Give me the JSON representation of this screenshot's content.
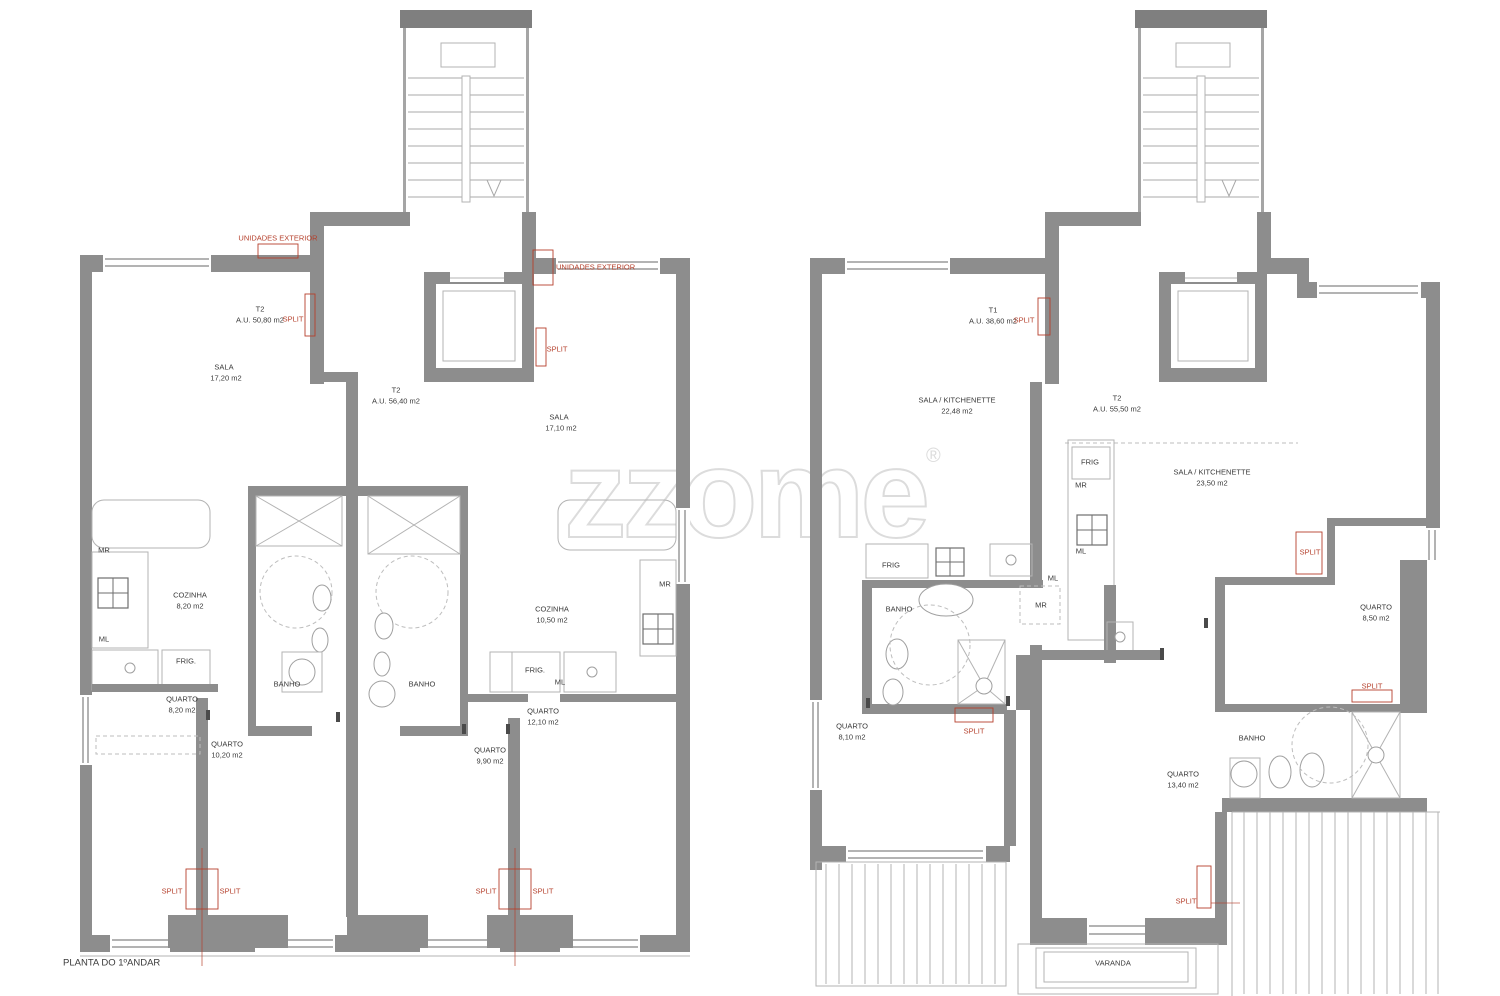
{
  "watermark": {
    "text": "zzome",
    "registered": "®"
  },
  "colors": {
    "wall": "#8d8d8d",
    "red": "#b5402c",
    "text": "#3a3a3a",
    "watermark": "#dcdcdc"
  },
  "drawing_title": "PLANTA DO 1ºANDAR",
  "labels": [
    {
      "name": "unidades-exterior-left",
      "text": "UNIDADES EXTERIOR",
      "x": 278,
      "y": 238,
      "color": "red"
    },
    {
      "name": "unit-t2a-name",
      "text": "T2",
      "x": 260,
      "y": 309
    },
    {
      "name": "unit-t2a-area",
      "text": "A.U. 50,80 m2",
      "x": 260,
      "y": 320
    },
    {
      "name": "split-t2a",
      "text": "SPLIT",
      "x": 293,
      "y": 319,
      "color": "red"
    },
    {
      "name": "sala-a-name",
      "text": "SALA",
      "x": 224,
      "y": 367
    },
    {
      "name": "sala-a-area",
      "text": "17,20 m2",
      "x": 226,
      "y": 378
    },
    {
      "name": "unit-t2b-name",
      "text": "T2",
      "x": 396,
      "y": 390
    },
    {
      "name": "unit-t2b-area",
      "text": "A.U. 56,40 m2",
      "x": 396,
      "y": 401
    },
    {
      "name": "unidades-exterior-right",
      "text": "UNIDADES EXTERIOR",
      "x": 556,
      "y": 267,
      "color": "red",
      "align": "left"
    },
    {
      "name": "split-t2b",
      "text": "SPLIT",
      "x": 557,
      "y": 349,
      "color": "red"
    },
    {
      "name": "sala-b-name",
      "text": "SALA",
      "x": 559,
      "y": 417
    },
    {
      "name": "sala-b-area",
      "text": "17,10 m2",
      "x": 561,
      "y": 428
    },
    {
      "name": "mr-a",
      "text": "MR",
      "x": 104,
      "y": 550
    },
    {
      "name": "cozinha-a-name",
      "text": "COZINHA",
      "x": 190,
      "y": 595
    },
    {
      "name": "cozinha-a-area",
      "text": "8,20 m2",
      "x": 190,
      "y": 606
    },
    {
      "name": "ml-a",
      "text": "ML",
      "x": 104,
      "y": 639
    },
    {
      "name": "frig-a",
      "text": "FRIG.",
      "x": 186,
      "y": 661
    },
    {
      "name": "quarto-1-name",
      "text": "QUARTO",
      "x": 182,
      "y": 699
    },
    {
      "name": "quarto-1-area",
      "text": "8,20 m2",
      "x": 182,
      "y": 710
    },
    {
      "name": "banho-a",
      "text": "BANHO",
      "x": 287,
      "y": 684
    },
    {
      "name": "banho-b",
      "text": "BANHO",
      "x": 422,
      "y": 684
    },
    {
      "name": "quarto-2-name",
      "text": "QUARTO",
      "x": 227,
      "y": 744
    },
    {
      "name": "quarto-2-area",
      "text": "10,20 m2",
      "x": 227,
      "y": 755
    },
    {
      "name": "quarto-3-name",
      "text": "QUARTO",
      "x": 490,
      "y": 750
    },
    {
      "name": "quarto-3-area",
      "text": "9,90 m2",
      "x": 490,
      "y": 761
    },
    {
      "name": "cozinha-b-name",
      "text": "COZINHA",
      "x": 552,
      "y": 609
    },
    {
      "name": "cozinha-b-area",
      "text": "10,50 m2",
      "x": 552,
      "y": 620
    },
    {
      "name": "mr-b",
      "text": "MR",
      "x": 665,
      "y": 584
    },
    {
      "name": "frig-b",
      "text": "FRIG.",
      "x": 535,
      "y": 670
    },
    {
      "name": "ml-b",
      "text": "ML",
      "x": 560,
      "y": 682
    },
    {
      "name": "quarto-4-name",
      "text": "QUARTO",
      "x": 543,
      "y": 711
    },
    {
      "name": "quarto-4-area",
      "text": "12,10 m2",
      "x": 543,
      "y": 722
    },
    {
      "name": "split-bl-1",
      "text": "SPLIT",
      "x": 172,
      "y": 891,
      "color": "red"
    },
    {
      "name": "split-bl-2",
      "text": "SPLIT",
      "x": 230,
      "y": 891,
      "color": "red"
    },
    {
      "name": "split-br-1",
      "text": "SPLIT",
      "x": 486,
      "y": 891,
      "color": "red"
    },
    {
      "name": "split-br-2",
      "text": "SPLIT",
      "x": 543,
      "y": 891,
      "color": "red"
    },
    {
      "name": "drawing-title",
      "text": "PLANTA DO 1ºANDAR",
      "x": 63,
      "y": 963,
      "size": 9.5,
      "align": "left"
    },
    {
      "name": "unit-t1-name",
      "text": "T1",
      "x": 993,
      "y": 310
    },
    {
      "name": "unit-t1-area",
      "text": "A.U. 38,60 m2",
      "x": 993,
      "y": 321
    },
    {
      "name": "split-t1",
      "text": "SPLIT",
      "x": 1024,
      "y": 320,
      "color": "red"
    },
    {
      "name": "sala-kitch-a-name",
      "text": "SALA / KITCHENETTE",
      "x": 957,
      "y": 400
    },
    {
      "name": "sala-kitch-a-area",
      "text": "22,48 m2",
      "x": 957,
      "y": 411
    },
    {
      "name": "unit-t2c-name",
      "text": "T2",
      "x": 1117,
      "y": 398
    },
    {
      "name": "unit-t2c-area",
      "text": "A.U. 55,50 m2",
      "x": 1117,
      "y": 409
    },
    {
      "name": "frig-c",
      "text": "FRIG",
      "x": 1090,
      "y": 462
    },
    {
      "name": "mr-c",
      "text": "MR",
      "x": 1081,
      "y": 485
    },
    {
      "name": "ml-c",
      "text": "ML",
      "x": 1081,
      "y": 551
    },
    {
      "name": "sala-kitch-b-name",
      "text": "SALA / KITCHENETTE",
      "x": 1212,
      "y": 472
    },
    {
      "name": "sala-kitch-b-area",
      "text": "23,50 m2",
      "x": 1212,
      "y": 483
    },
    {
      "name": "split-t2c-1",
      "text": "SPLIT",
      "x": 1310,
      "y": 552,
      "color": "red"
    },
    {
      "name": "quarto-5-name",
      "text": "QUARTO",
      "x": 1376,
      "y": 607
    },
    {
      "name": "quarto-5-area",
      "text": "8,50 m2",
      "x": 1376,
      "y": 618
    },
    {
      "name": "split-t2c-2",
      "text": "SPLIT",
      "x": 1372,
      "y": 686,
      "color": "red"
    },
    {
      "name": "frig-d",
      "text": "FRIG",
      "x": 891,
      "y": 565
    },
    {
      "name": "ml-d",
      "text": "ML",
      "x": 1053,
      "y": 578
    },
    {
      "name": "banho-c",
      "text": "BANHO",
      "x": 899,
      "y": 609
    },
    {
      "name": "mr-d",
      "text": "MR",
      "x": 1041,
      "y": 605
    },
    {
      "name": "quarto-6-name",
      "text": "QUARTO",
      "x": 852,
      "y": 726
    },
    {
      "name": "quarto-6-area",
      "text": "8,10 m2",
      "x": 852,
      "y": 737
    },
    {
      "name": "split-t1-2",
      "text": "SPLIT",
      "x": 974,
      "y": 731,
      "color": "red"
    },
    {
      "name": "banho-d",
      "text": "BANHO",
      "x": 1252,
      "y": 738
    },
    {
      "name": "quarto-7-name",
      "text": "QUARTO",
      "x": 1183,
      "y": 774
    },
    {
      "name": "quarto-7-area",
      "text": "13,40 m2",
      "x": 1183,
      "y": 785
    },
    {
      "name": "split-t2c-3",
      "text": "SPLIT",
      "x": 1186,
      "y": 901,
      "color": "red"
    },
    {
      "name": "varanda",
      "text": "VARANDA",
      "x": 1113,
      "y": 963
    }
  ]
}
